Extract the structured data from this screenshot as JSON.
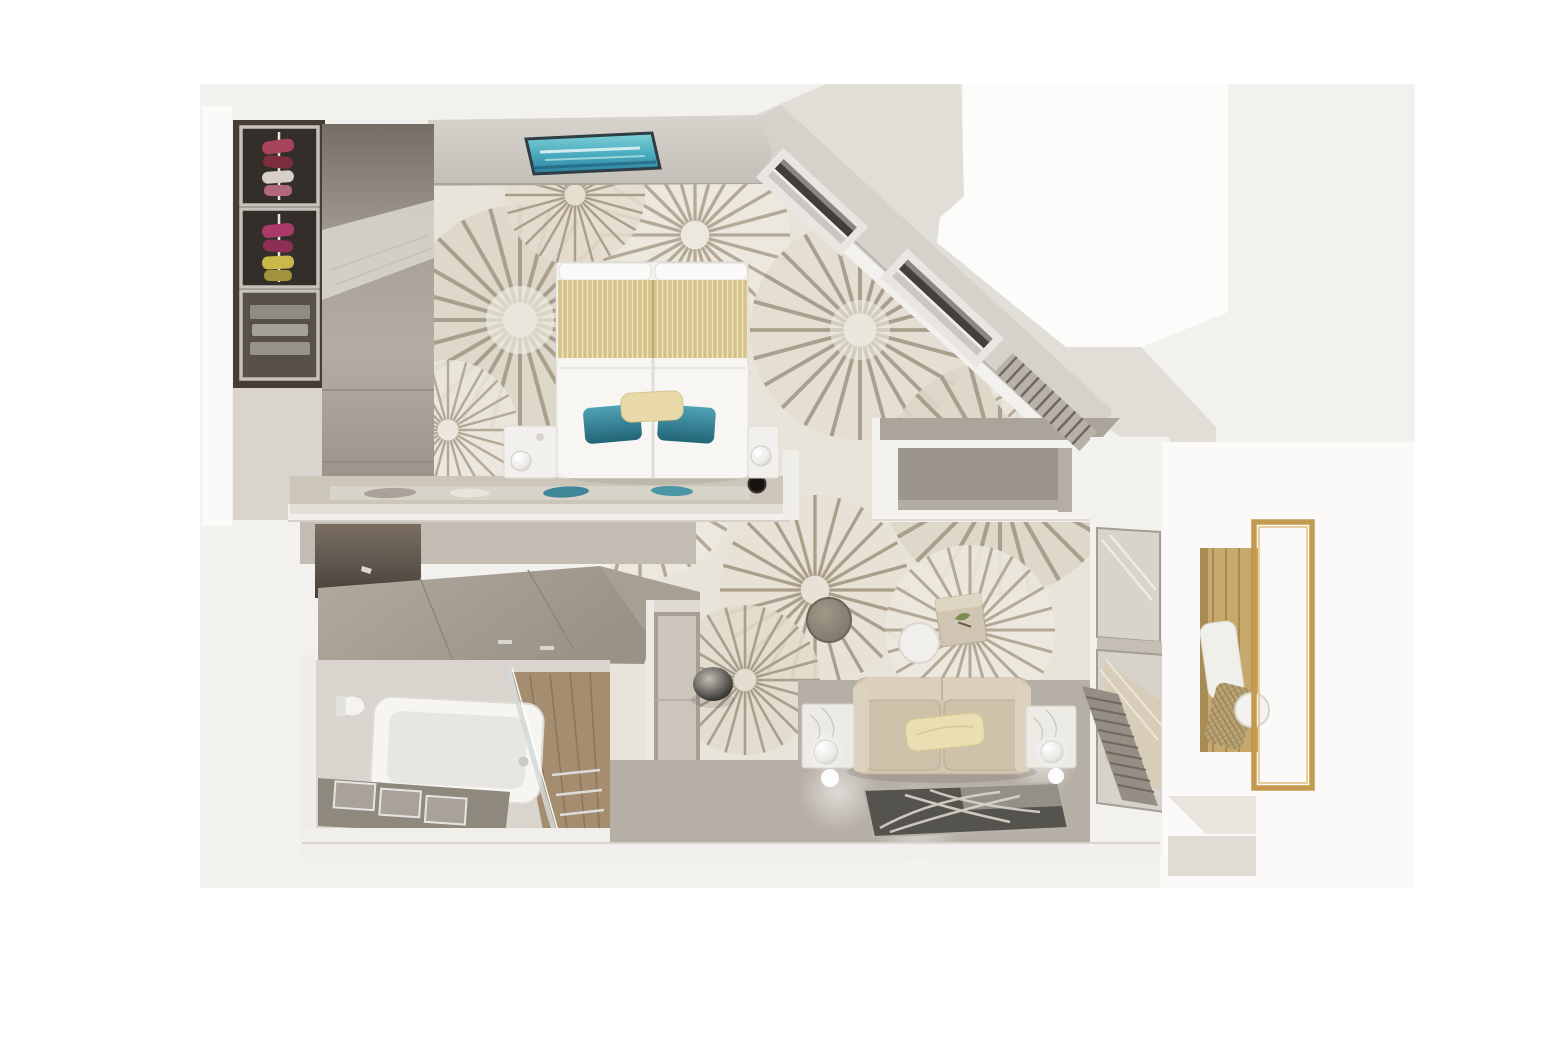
{
  "scene": {
    "type": "3d-floor-plan-render",
    "view": "top-down-dollhouse",
    "subject": "suite-floorplan"
  },
  "rooms": {
    "bedroom": {
      "label": "bedroom",
      "furniture": [
        "double-bed",
        "headboard-runner",
        "teal-pillows",
        "cream-pillow",
        "left-nightstand",
        "right-nightstand",
        "sphere-lamps",
        "foot-console-ledge",
        "decor-runner",
        "black-speaker-disc"
      ]
    },
    "closet": {
      "label": "wardrobe-closet",
      "furniture": [
        "open-shelf-cubbies",
        "hanging-clothes",
        "sliding-door-panel"
      ]
    },
    "living_area": {
      "label": "living-area",
      "furniture": [
        "sofa",
        "cream-cushion",
        "marble-cube-side-tables",
        "glass-sphere-lamps",
        "dark-round-table",
        "white-round-table",
        "cube-accent-table",
        "gray-pouf",
        "feather-area-rug",
        "louver-bench"
      ]
    },
    "vanity_desk": {
      "label": "vanity-desk-area",
      "furniture": [
        "desk-counter",
        "mirror-panel",
        "storage-cabinet"
      ]
    },
    "bathroom": {
      "label": "bathroom",
      "furniture": [
        "bathtub",
        "vanity-sinks",
        "glass-shower-partition",
        "wood-shower-floor",
        "toilet"
      ]
    },
    "balcony": {
      "label": "balcony",
      "furniture": [
        "wood-deck",
        "lounge-chair",
        "round-side-table",
        "gold-railing-frame"
      ]
    },
    "architecture": {
      "features": [
        "skylight-art-panel",
        "sloped-diagonal-wall",
        "slanted-wall-windows",
        "tv-alcove-nook",
        "window-wall",
        "exterior-steps"
      ]
    }
  },
  "colors": {
    "backdrop": "#f2f1ee",
    "exterior_mass": "#e1ded8",
    "diagonal_wall": "#d6d2cb",
    "wall_light": "#f2f0ec",
    "carpet": "#e8e4da",
    "carpet_spokes": "#a99f8d",
    "burst_dark": "#ddd6c8",
    "burst_light": "#ece8de",
    "floor_taupe": "#b6afa5",
    "accent_teal": "#2f7f93",
    "accent_gold": "#c39a4f",
    "bed_runner_gold": "#d4c48c",
    "sofa_beige": "#d3c6b0",
    "rug_dark": "#55534d",
    "deck_wood": "#c7a96e",
    "closet_dark": "#453d36",
    "glass": "#d8d3cb",
    "cabinet_taupe": "#a89f94"
  }
}
